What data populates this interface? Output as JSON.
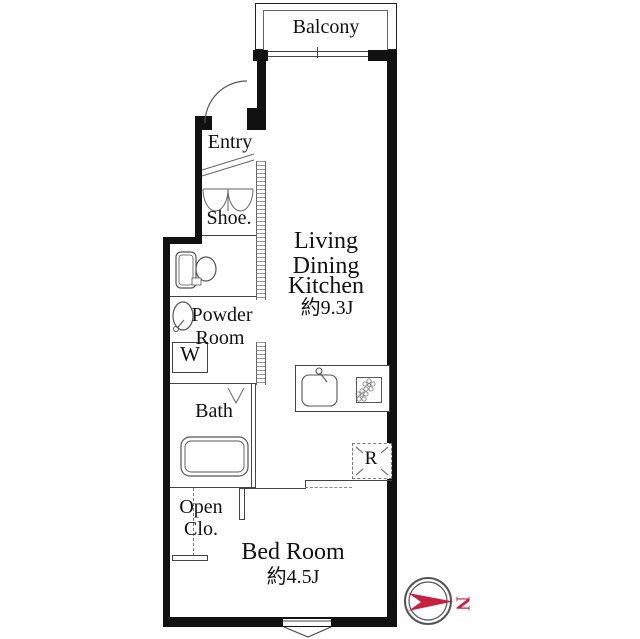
{
  "rooms": {
    "balcony": {
      "label": "Balcony"
    },
    "entry": {
      "label": "Entry"
    },
    "shoe": {
      "label": "Shoe."
    },
    "living": {
      "line1": "Living",
      "line2": "Dining",
      "line3": "Kitchen",
      "area": "約9.3J"
    },
    "powder_room": {
      "line1": "Powder",
      "line2": "Room"
    },
    "washer": {
      "label": "W"
    },
    "bath": {
      "label": "Bath"
    },
    "open_closet": {
      "line1": "Open",
      "line2": "Clo."
    },
    "bedroom": {
      "label": "Bed Room",
      "area": "約4.5J"
    },
    "refrigerator": {
      "label": "R"
    }
  },
  "compass": {
    "north_letter": "N"
  },
  "colors": {
    "wall": "#111111",
    "line": "#444444",
    "hatch": "#9a9a9a",
    "compass_red": "#c8223f",
    "text": "#111111"
  }
}
